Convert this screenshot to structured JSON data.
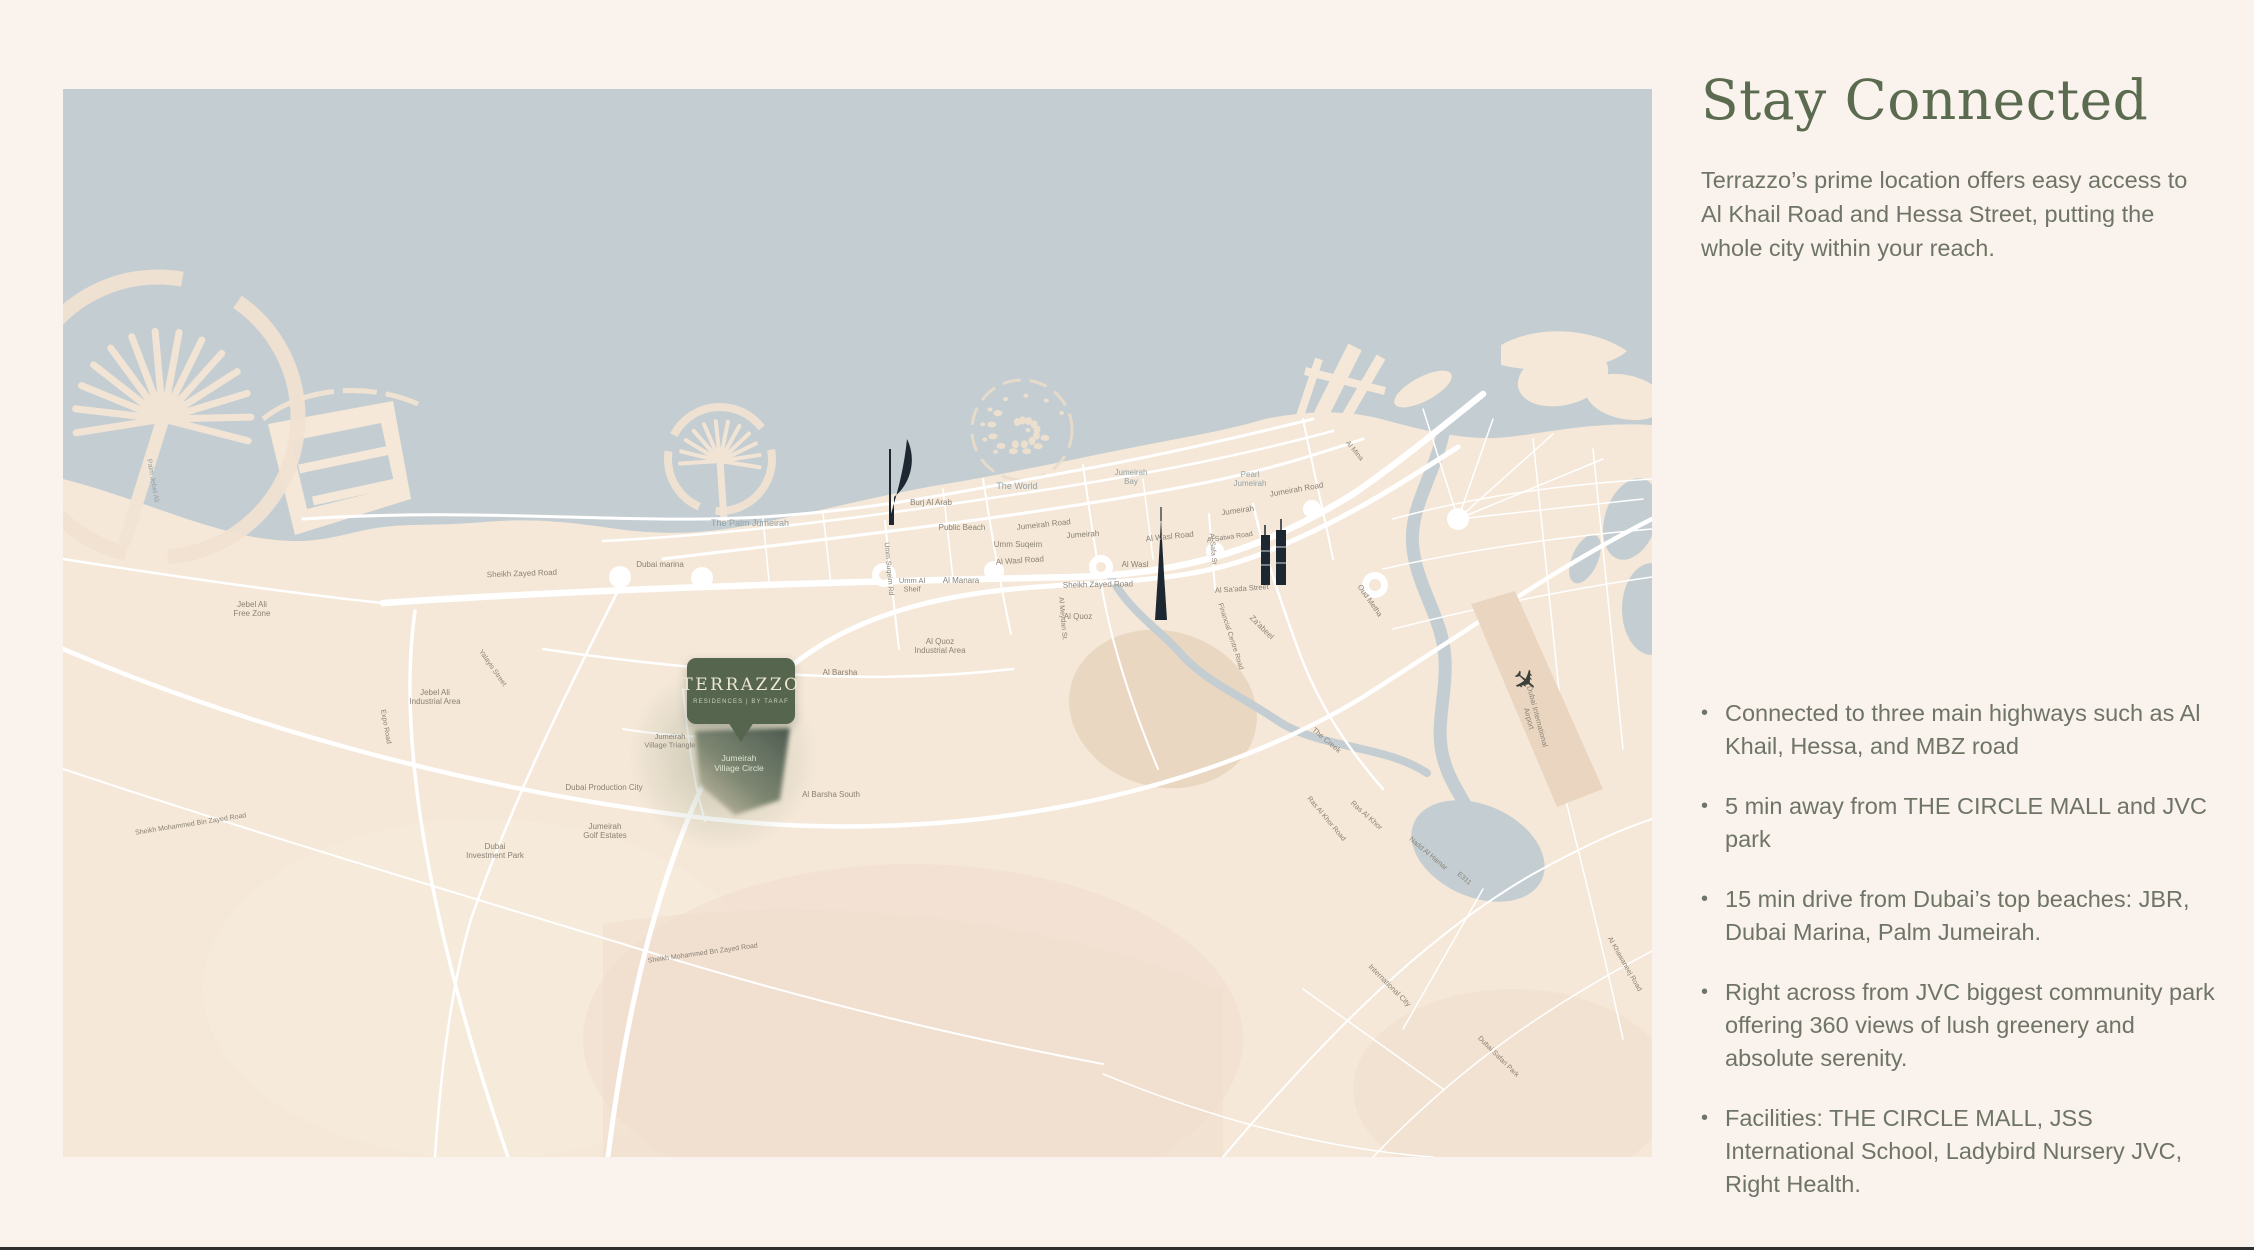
{
  "panel": {
    "title": "Stay Connected",
    "description": "Terrazzo’s prime location offers easy access to Al Khail Road and Hessa Street, putting the whole city within your reach.",
    "bullets": [
      "Connected to three main highways such as Al Khail, Hessa, and MBZ road",
      "5 min away from THE CIRCLE MALL and JVC park",
      "15 min drive from Dubai’s top beaches: JBR, Dubai Marina, Palm Jumeirah.",
      "Right across from JVC biggest community park offering 360 views of lush greenery and absolute serenity.",
      "Facilities: THE CIRCLE MALL, JSS International School, Ladybird Nursery JVC, Right Health."
    ],
    "title_color": "#5a6b4f",
    "text_color": "#6f7566"
  },
  "marker": {
    "name": "TERRAZZO",
    "subtitle": "RESIDENCES | BY TARAF",
    "bg_color": "#56654e",
    "text_color": "#eee7d4"
  },
  "map": {
    "sea_color": "#c4ced2",
    "land_color": "#f5e8d8",
    "road_color": "#ffffff",
    "label_color": "#8a8275",
    "sea_label_color": "#93a2a7",
    "jvc_label_color": "#dde4d2",
    "labels": [
      {
        "t": "The Palm Jumeirah",
        "x": 687,
        "y": 437,
        "s": 9,
        "c": "sea"
      },
      {
        "t": "The World",
        "x": 954,
        "y": 400,
        "s": 9,
        "c": "sea"
      },
      {
        "t": "Jumeirah\nBay",
        "x": 1068,
        "y": 386,
        "s": 8,
        "c": "sea"
      },
      {
        "t": "Pearl\nJumeirah",
        "x": 1187,
        "y": 388,
        "s": 8,
        "c": "sea"
      },
      {
        "t": "Palm Jebel Ali",
        "x": 88,
        "y": 392,
        "r": 80,
        "s": 7,
        "c": "sea"
      },
      {
        "t": "Burj Al Arab",
        "x": 868,
        "y": 416,
        "s": 8
      },
      {
        "t": "Public Beach",
        "x": 899,
        "y": 441,
        "s": 8
      },
      {
        "t": "Dubai marina",
        "x": 597,
        "y": 478,
        "s": 8
      },
      {
        "t": "Jumeirah Road",
        "x": 981,
        "y": 438,
        "r": -6,
        "s": 8
      },
      {
        "t": "Umm Suqeim",
        "x": 955,
        "y": 458,
        "s": 8
      },
      {
        "t": "Al Wasl Road",
        "x": 957,
        "y": 474,
        "r": -4,
        "s": 8
      },
      {
        "t": "Jumeirah",
        "x": 1020,
        "y": 448,
        "r": -4,
        "s": 8
      },
      {
        "t": "Al Wasl Road",
        "x": 1107,
        "y": 450,
        "r": -6,
        "s": 8
      },
      {
        "t": "Al Wasl",
        "x": 1072,
        "y": 478,
        "s": 8
      },
      {
        "t": "Jumeirah",
        "x": 1175,
        "y": 424,
        "r": -8,
        "s": 8
      },
      {
        "t": "Jumeirah Road",
        "x": 1234,
        "y": 403,
        "r": -10,
        "s": 8
      },
      {
        "t": "Al Manara",
        "x": 898,
        "y": 494,
        "s": 8
      },
      {
        "t": "Umm Al\nSheif",
        "x": 849,
        "y": 494,
        "s": 7.5
      },
      {
        "t": "Umm Suqeim Rd",
        "x": 824,
        "y": 480,
        "r": 85,
        "s": 7
      },
      {
        "t": "Sheikh Zayed Road",
        "x": 459,
        "y": 487,
        "r": -2,
        "s": 8
      },
      {
        "t": "Sheikh Zayed Road",
        "x": 1035,
        "y": 498,
        "r": -1,
        "s": 8
      },
      {
        "t": "Al Quoz\nIndustrial Area",
        "x": 877,
        "y": 555,
        "s": 8
      },
      {
        "t": "Al Quoz",
        "x": 1015,
        "y": 530,
        "s": 8
      },
      {
        "t": "Al Barsha",
        "x": 777,
        "y": 586,
        "s": 8
      },
      {
        "t": "Al Barsha South",
        "x": 768,
        "y": 708,
        "s": 8
      },
      {
        "t": "Jumeirah\nVillage Triangle",
        "x": 607,
        "y": 650,
        "s": 7.5
      },
      {
        "t": "Dubai Production City",
        "x": 541,
        "y": 701,
        "s": 8
      },
      {
        "t": "Jumeirah\nGolf Estates",
        "x": 542,
        "y": 740,
        "s": 8
      },
      {
        "t": "Dubai\nInvestment Park",
        "x": 432,
        "y": 760,
        "s": 8
      },
      {
        "t": "Jebel Ali\nFree Zone",
        "x": 189,
        "y": 518,
        "s": 8
      },
      {
        "t": "Jebel Ali\nIndustrial Area",
        "x": 372,
        "y": 606,
        "s": 8
      },
      {
        "t": "Sheikh Mohammed Bin Zayed Road",
        "x": 128,
        "y": 737,
        "r": -9,
        "s": 7
      },
      {
        "t": "Sheikh Mohammed Bn Zayed Road",
        "x": 640,
        "y": 866,
        "r": -8,
        "s": 7
      },
      {
        "t": "Expo Road",
        "x": 321,
        "y": 638,
        "r": 80,
        "s": 7
      },
      {
        "t": "Yalayis Street",
        "x": 428,
        "y": 580,
        "r": 55,
        "s": 7
      },
      {
        "t": "Za'abeel",
        "x": 1197,
        "y": 540,
        "r": 45,
        "s": 8
      },
      {
        "t": "Oud Metha",
        "x": 1305,
        "y": 513,
        "r": 55,
        "s": 7.5
      },
      {
        "t": "The Creek",
        "x": 1262,
        "y": 653,
        "r": 40,
        "s": 7.5
      },
      {
        "t": "Dubai International\nAirport",
        "x": 1472,
        "y": 628,
        "r": 75,
        "s": 7.5
      },
      {
        "t": "Al Safa St",
        "x": 1148,
        "y": 460,
        "r": 85,
        "s": 7
      },
      {
        "t": "Al Satwa Road",
        "x": 1167,
        "y": 450,
        "r": -8,
        "s": 7
      },
      {
        "t": "Al Sa'ada Street",
        "x": 1179,
        "y": 502,
        "r": -4,
        "s": 7.5
      },
      {
        "t": "Financial Centre Road",
        "x": 1166,
        "y": 548,
        "r": 72,
        "s": 7
      },
      {
        "t": "Al Meydan St.",
        "x": 998,
        "y": 530,
        "r": 85,
        "s": 7
      },
      {
        "t": "Al Mina",
        "x": 1290,
        "y": 363,
        "r": 50,
        "s": 7
      },
      {
        "t": "Ras Al Khor",
        "x": 1302,
        "y": 728,
        "r": 42,
        "s": 7.5
      },
      {
        "t": "Ras Al Khor Road",
        "x": 1262,
        "y": 731,
        "r": 50,
        "s": 7
      },
      {
        "t": "International City",
        "x": 1325,
        "y": 898,
        "r": 45,
        "s": 7.5
      },
      {
        "t": "Nadd Al Hamar",
        "x": 1364,
        "y": 766,
        "r": 40,
        "s": 7
      },
      {
        "t": "Al Khawaneej Road",
        "x": 1560,
        "y": 876,
        "r": 60,
        "s": 7
      },
      {
        "t": "Dubai Safari Park",
        "x": 1434,
        "y": 969,
        "r": 45,
        "s": 7
      },
      {
        "t": "E311",
        "x": 1400,
        "y": 791,
        "r": 40,
        "s": 7
      },
      {
        "t": "Jumeirah\nVillage Circle",
        "x": 676,
        "y": 672,
        "s": 8.5,
        "c": "jvc"
      }
    ]
  }
}
